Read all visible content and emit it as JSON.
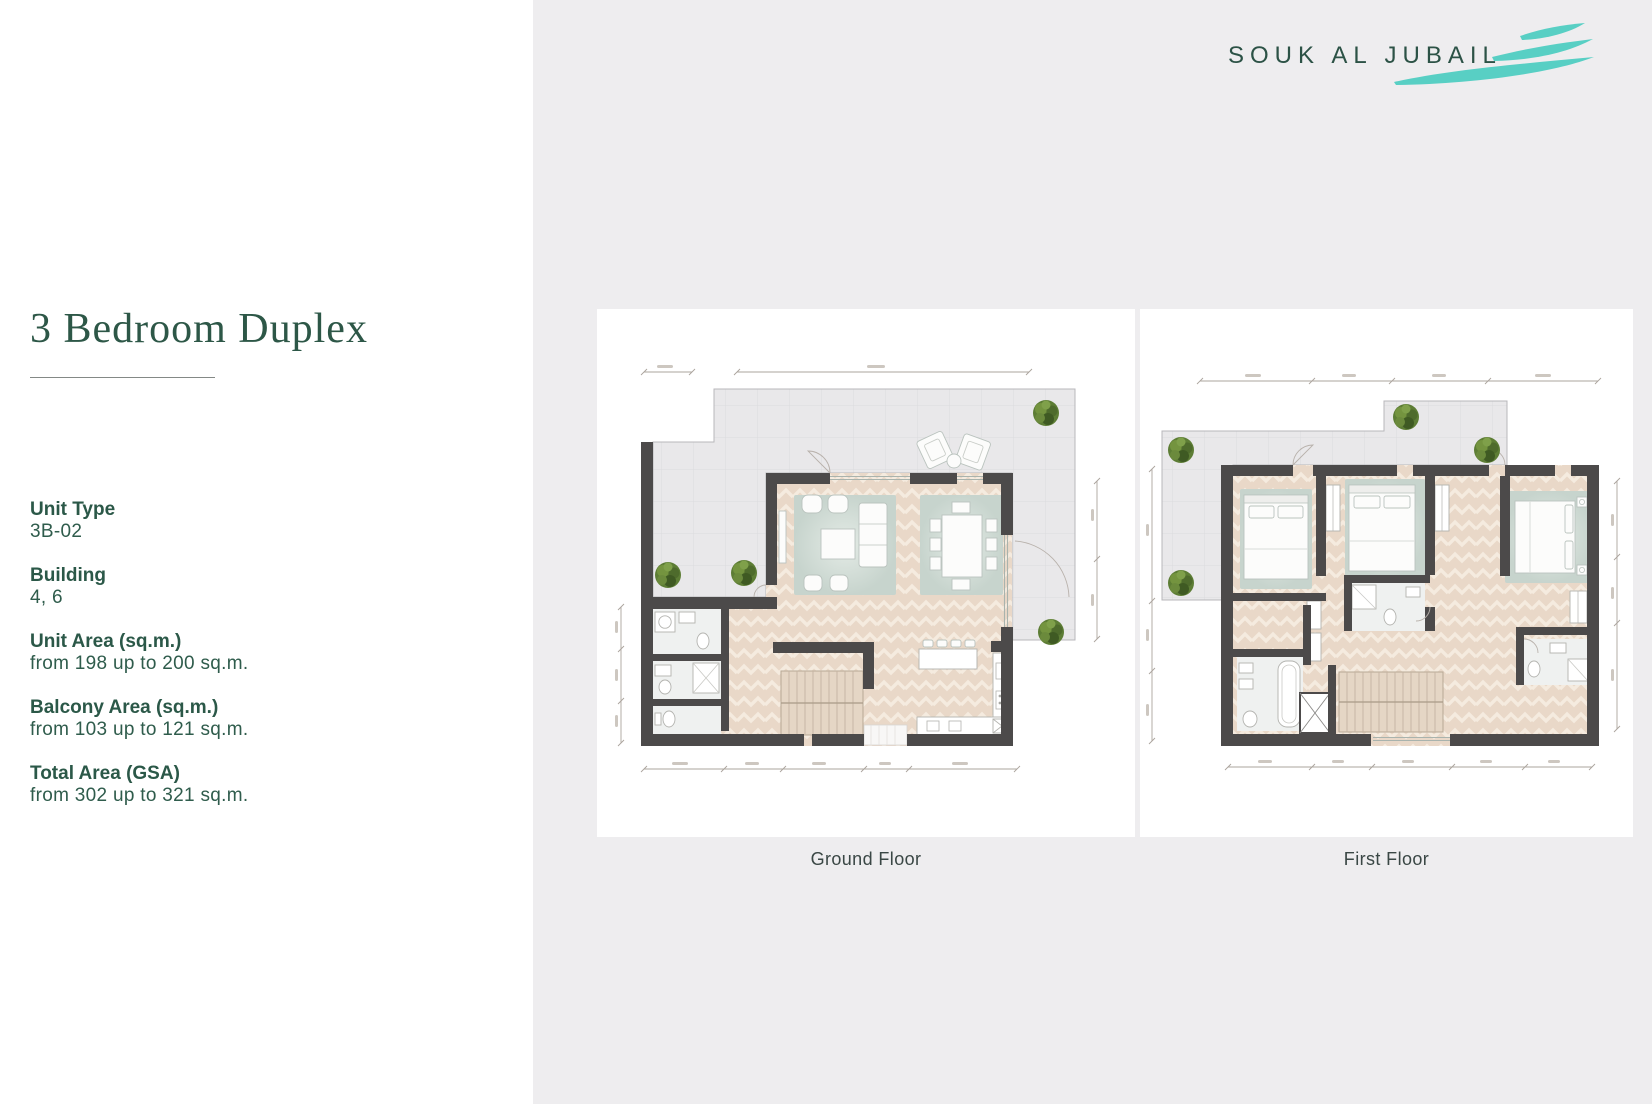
{
  "brand": {
    "name": "SOUK AL JUBAIL"
  },
  "page_title": "3 Bedroom Duplex",
  "details": [
    {
      "label": "Unit Type",
      "value": "3B-02"
    },
    {
      "label": "Building",
      "value": "4, 6"
    },
    {
      "label": "Unit Area (sq.m.)",
      "value": "from 198 up to 200 sq.m."
    },
    {
      "label": "Balcony Area (sq.m.)",
      "value": "from 103 up to 121 sq.m."
    },
    {
      "label": "Total Area (GSA)",
      "value": "from 302 up to 321 sq.m."
    }
  ],
  "floors": [
    {
      "label": "Ground Floor",
      "depicts": "terrace, living room, dining room, kitchen, stairs, laundry, bathrooms"
    },
    {
      "label": "First Floor",
      "depicts": "terrace, three bedrooms, bathrooms, stairs"
    }
  ],
  "palette": {
    "brand_green": "#2d5747",
    "wave_teal": "#58cfc4",
    "wall": "#4c4a4a",
    "floor_beige": "#e9d8c8",
    "rug_sage": "#ccd8d2",
    "terrace_gray": "#e9e8ea",
    "tree_green": "#5d7d35",
    "page_bg_right": "#eeedef"
  }
}
